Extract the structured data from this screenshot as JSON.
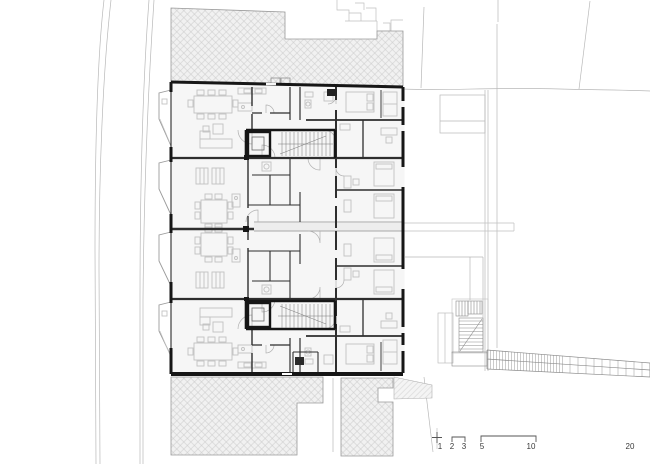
{
  "canvas": {
    "width": 650,
    "height": 464,
    "background": "#ffffff"
  },
  "palette": {
    "wall": "#161616",
    "partition": "#2e2e2e",
    "furniture": "#c1c1c1",
    "site_line": "#b8b8b8",
    "hatch_fill": "#f1f1f1",
    "hatch_line": "#c9c9c9",
    "hatch_outline": "#9a9a9a",
    "floor_fill": "#f6f6f6",
    "detail": "#8c8c8c",
    "scale_text": "#3a3a3a"
  },
  "scale_bar": {
    "labels": [
      {
        "value": "1"
      },
      {
        "value": "2"
      },
      {
        "value": "3"
      },
      {
        "value": "5"
      },
      {
        "value": "10"
      },
      {
        "value": "20"
      }
    ]
  }
}
